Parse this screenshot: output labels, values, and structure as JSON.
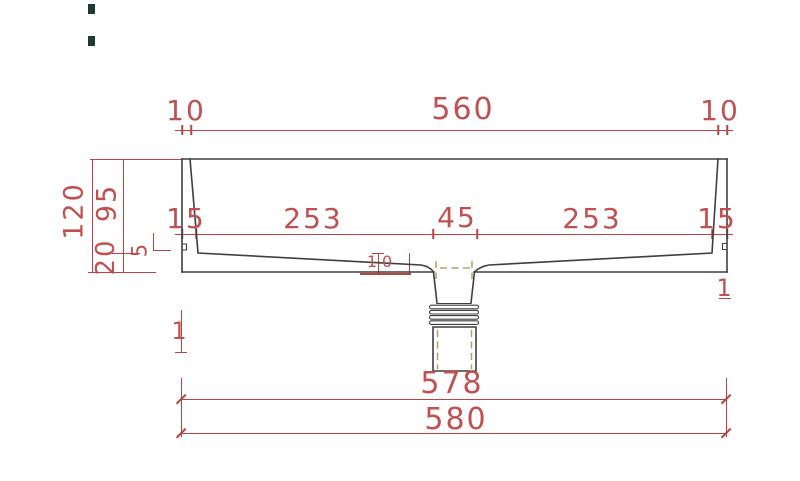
{
  "colors": {
    "dimension_red": "#bb4343",
    "dimension_text": "#c25050",
    "outline_dark": "#3f3f3f",
    "hidden_olive": "#b3a05e",
    "mark_teal": "#203b31"
  },
  "labels": {
    "top": {
      "left_overhang": "10",
      "rim_width": "560",
      "right_overhang": "10"
    },
    "inner": {
      "left_wall": "15",
      "left_basin": "253",
      "drain_width": "45",
      "right_basin": "253",
      "right_wall": "15"
    },
    "left_side": {
      "total_height": "120",
      "bowl_depth": "95",
      "base_thickness": "20",
      "step": "5"
    },
    "drain": {
      "floor_thickness": "10"
    },
    "edges": {
      "left": "1",
      "right": "1"
    },
    "bottom": {
      "inner_width": "578",
      "overall_width": "580"
    }
  }
}
